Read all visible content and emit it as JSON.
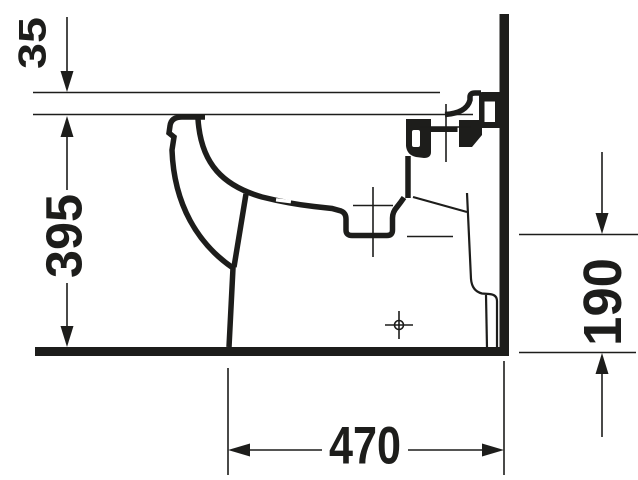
{
  "drawing": {
    "title": "bidet-side-elevation",
    "colors": {
      "ink": "#1d1d1b",
      "background": "#ffffff"
    },
    "labels": {
      "dim_35": "35",
      "dim_395": "395",
      "dim_190": "190",
      "dim_470": "470"
    }
  }
}
